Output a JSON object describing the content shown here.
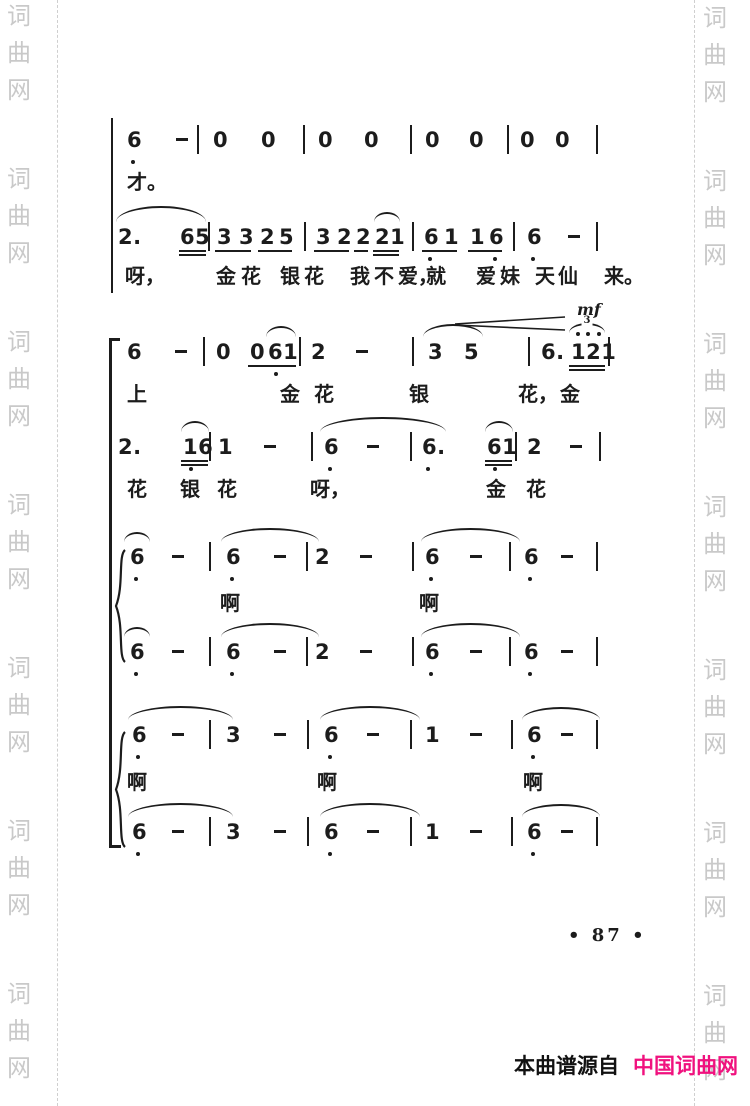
{
  "colors": {
    "ink": "#1c1c1c",
    "watermark": "#c9c9c9",
    "pink": "#f0117e",
    "edge_dash": "#cfcfcf"
  },
  "watermark": {
    "text": "词曲网",
    "chars": [
      "词",
      "曲",
      "网"
    ],
    "repeat_groups": 7,
    "group_pitch": 163,
    "left_start_y": 4,
    "right_start_y": 6
  },
  "footer": {
    "page_number": "• 87 •",
    "source_prefix": "本曲谱源自",
    "source_site": "中国词曲网"
  },
  "score": {
    "notation_system": "jianpu",
    "dynamic_marking": "mf",
    "elements": [
      {
        "kind": "vline",
        "name": "system-barline-1",
        "x": 111,
        "y1": 118,
        "y2": 293,
        "w": 2
      },
      {
        "kind": "vline",
        "name": "system-barline-2",
        "x": 109,
        "y1": 338,
        "y2": 848,
        "w": 3,
        "hooks": true
      },
      {
        "kind": "brace",
        "name": "voice-brace-1",
        "x": 113,
        "y1": 549,
        "y2": 663
      },
      {
        "kind": "brace",
        "name": "voice-brace-2",
        "x": 113,
        "y1": 731,
        "y2": 848
      },
      {
        "kind": "notes",
        "y": 128,
        "tokens": [
          {
            "t": "6",
            "x": 127
          },
          {
            "t": "-",
            "x": 176
          },
          {
            "t": "|",
            "x": 197
          },
          {
            "t": "0",
            "x": 213
          },
          {
            "t": "0",
            "x": 261
          },
          {
            "t": "|",
            "x": 303
          },
          {
            "t": "0",
            "x": 318
          },
          {
            "t": "0",
            "x": 364
          },
          {
            "t": "|",
            "x": 410
          },
          {
            "t": "0",
            "x": 425
          },
          {
            "t": "0",
            "x": 469
          },
          {
            "t": "|",
            "x": 507
          },
          {
            "t": "0",
            "x": 520
          },
          {
            "t": "0",
            "x": 555
          },
          {
            "t": "|",
            "x": 596
          }
        ],
        "dots": [
          {
            "x": 131,
            "pos": "b"
          }
        ]
      },
      {
        "kind": "lyrics",
        "y": 170,
        "items": [
          {
            "t": "才。",
            "x": 127
          }
        ]
      },
      {
        "kind": "notes",
        "y": 225,
        "tokens": [
          {
            "t": "2.",
            "x": 118
          },
          {
            "t": "65",
            "x": 180
          },
          {
            "t": "|",
            "x": 208
          },
          {
            "t": "3",
            "x": 217
          },
          {
            "t": "3",
            "x": 239
          },
          {
            "t": "2",
            "x": 260
          },
          {
            "t": "5",
            "x": 279
          },
          {
            "t": "|",
            "x": 304
          },
          {
            "t": "3",
            "x": 316
          },
          {
            "t": "2",
            "x": 337
          },
          {
            "t": "2",
            "x": 356
          },
          {
            "t": "21",
            "x": 375
          },
          {
            "t": "|",
            "x": 412
          },
          {
            "t": "6",
            "x": 424
          },
          {
            "t": "1",
            "x": 444
          },
          {
            "t": "1",
            "x": 470
          },
          {
            "t": "6",
            "x": 489
          },
          {
            "t": "|",
            "x": 513
          },
          {
            "t": "6",
            "x": 527
          },
          {
            "t": "-",
            "x": 568
          },
          {
            "t": "|",
            "x": 596
          }
        ],
        "slurs": [
          {
            "x1": 116,
            "x2": 206,
            "h": 14
          },
          {
            "x1": 374,
            "x2": 400,
            "h": 8
          }
        ],
        "unders": [
          {
            "x1": 179,
            "x2": 206,
            "n": 2
          },
          {
            "x1": 215,
            "x2": 251,
            "n": 1
          },
          {
            "x1": 258,
            "x2": 292,
            "n": 1
          },
          {
            "x1": 314,
            "x2": 349,
            "n": 1
          },
          {
            "x1": 354,
            "x2": 368,
            "n": 1
          },
          {
            "x1": 373,
            "x2": 399,
            "n": 2
          },
          {
            "x1": 422,
            "x2": 457,
            "n": 1
          },
          {
            "x1": 468,
            "x2": 502,
            "n": 1
          }
        ],
        "dots": [
          {
            "x": 428,
            "pos": "b"
          },
          {
            "x": 493,
            "pos": "b"
          },
          {
            "x": 531,
            "pos": "b"
          }
        ]
      },
      {
        "kind": "lyrics",
        "y": 264,
        "items": [
          {
            "t": "呀，",
            "x": 125
          },
          {
            "t": "金",
            "x": 216
          },
          {
            "t": "花",
            "x": 241
          },
          {
            "t": "银",
            "x": 280
          },
          {
            "t": "花",
            "x": 304
          },
          {
            "t": "我",
            "x": 350
          },
          {
            "t": "不",
            "x": 374
          },
          {
            "t": "爱，",
            "x": 398
          },
          {
            "t": "就",
            "x": 426
          },
          {
            "t": "爱",
            "x": 476
          },
          {
            "t": "妹",
            "x": 500
          },
          {
            "t": "天",
            "x": 535
          },
          {
            "t": "仙",
            "x": 558
          },
          {
            "t": "来。",
            "x": 604
          }
        ]
      },
      {
        "kind": "hairpin",
        "name": "crescendo-hairpin",
        "x1": 455,
        "x2": 565,
        "y": 314
      },
      {
        "kind": "text",
        "name": "dynamic-mf",
        "t": "mf",
        "x": 577,
        "y": 300
      },
      {
        "kind": "notes",
        "y": 340,
        "tokens": [
          {
            "t": "6",
            "x": 127
          },
          {
            "t": "-",
            "x": 175
          },
          {
            "t": "|",
            "x": 203
          },
          {
            "t": "0",
            "x": 216
          },
          {
            "t": "0",
            "x": 250
          },
          {
            "t": "61",
            "x": 268
          },
          {
            "t": "|",
            "x": 299
          },
          {
            "t": "2",
            "x": 311
          },
          {
            "t": "-",
            "x": 356
          },
          {
            "t": "|",
            "x": 412
          },
          {
            "t": "3",
            "x": 428
          },
          {
            "t": "5",
            "x": 464
          },
          {
            "t": "|",
            "x": 528
          },
          {
            "t": "6.",
            "x": 541
          },
          {
            "t": "121",
            "x": 571
          },
          {
            "t": "|",
            "x": 608
          }
        ],
        "slurs": [
          {
            "x1": 266,
            "x2": 296,
            "h": 9
          },
          {
            "x1": 423,
            "x2": 483,
            "h": 11
          },
          {
            "x1": 569,
            "x2": 605,
            "h": 8,
            "label": "3"
          }
        ],
        "unders": [
          {
            "x1": 248,
            "x2": 296,
            "n": 1
          },
          {
            "x1": 569,
            "x2": 605,
            "n": 2
          }
        ],
        "dots": [
          {
            "x": 274,
            "pos": "b"
          },
          {
            "x": 576,
            "pos": "a"
          },
          {
            "x": 586,
            "pos": "a"
          },
          {
            "x": 597,
            "pos": "a"
          }
        ]
      },
      {
        "kind": "lyrics",
        "y": 382,
        "items": [
          {
            "t": "上",
            "x": 127
          },
          {
            "t": "金",
            "x": 280
          },
          {
            "t": "花",
            "x": 314
          },
          {
            "t": "银",
            "x": 409
          },
          {
            "t": "花，",
            "x": 518
          },
          {
            "t": "金",
            "x": 560
          }
        ]
      },
      {
        "kind": "notes",
        "y": 435,
        "tokens": [
          {
            "t": "2.",
            "x": 118
          },
          {
            "t": "16",
            "x": 183
          },
          {
            "t": "|",
            "x": 209
          },
          {
            "t": "1",
            "x": 218
          },
          {
            "t": "-",
            "x": 264
          },
          {
            "t": "|",
            "x": 311
          },
          {
            "t": "6",
            "x": 324
          },
          {
            "t": "-",
            "x": 367
          },
          {
            "t": "|",
            "x": 410
          },
          {
            "t": "6.",
            "x": 422
          },
          {
            "t": "61",
            "x": 487
          },
          {
            "t": "|",
            "x": 515
          },
          {
            "t": "2",
            "x": 527
          },
          {
            "t": "-",
            "x": 570
          },
          {
            "t": "|",
            "x": 599
          }
        ],
        "slurs": [
          {
            "x1": 181,
            "x2": 209,
            "h": 9
          },
          {
            "x1": 320,
            "x2": 446,
            "h": 13
          },
          {
            "x1": 485,
            "x2": 513,
            "h": 9
          }
        ],
        "unders": [
          {
            "x1": 181,
            "x2": 208,
            "n": 2
          },
          {
            "x1": 485,
            "x2": 512,
            "n": 2
          }
        ],
        "dots": [
          {
            "x": 189,
            "pos": "b"
          },
          {
            "x": 328,
            "pos": "b"
          },
          {
            "x": 426,
            "pos": "b"
          },
          {
            "x": 493,
            "pos": "b"
          }
        ]
      },
      {
        "kind": "lyrics",
        "y": 477,
        "items": [
          {
            "t": "花",
            "x": 127
          },
          {
            "t": "银",
            "x": 180
          },
          {
            "t": "花",
            "x": 217
          },
          {
            "t": "呀，",
            "x": 310
          },
          {
            "t": "金",
            "x": 486
          },
          {
            "t": "花",
            "x": 526
          }
        ]
      },
      {
        "kind": "notes",
        "y": 545,
        "tokens": [
          {
            "t": "6",
            "x": 130
          },
          {
            "t": "-",
            "x": 172
          },
          {
            "t": "|",
            "x": 209
          },
          {
            "t": "6",
            "x": 226
          },
          {
            "t": "-",
            "x": 274
          },
          {
            "t": "|",
            "x": 306
          },
          {
            "t": "2",
            "x": 315
          },
          {
            "t": "-",
            "x": 360
          },
          {
            "t": "|",
            "x": 412
          },
          {
            "t": "6",
            "x": 425
          },
          {
            "t": "-",
            "x": 470
          },
          {
            "t": "|",
            "x": 509
          },
          {
            "t": "6",
            "x": 524
          },
          {
            "t": "-",
            "x": 561
          },
          {
            "t": "|",
            "x": 596
          }
        ],
        "slurs": [
          {
            "x1": 124,
            "x2": 150,
            "h": 8
          },
          {
            "x1": 221,
            "x2": 319,
            "h": 12
          },
          {
            "x1": 421,
            "x2": 520,
            "h": 12
          }
        ],
        "dots": [
          {
            "x": 134,
            "pos": "b"
          },
          {
            "x": 230,
            "pos": "b"
          },
          {
            "x": 429,
            "pos": "b"
          },
          {
            "x": 528,
            "pos": "b"
          }
        ]
      },
      {
        "kind": "lyrics",
        "y": 591,
        "items": [
          {
            "t": "啊",
            "x": 220
          },
          {
            "t": "啊",
            "x": 419
          }
        ]
      },
      {
        "kind": "notes",
        "y": 640,
        "tokens": [
          {
            "t": "6",
            "x": 130
          },
          {
            "t": "-",
            "x": 172
          },
          {
            "t": "|",
            "x": 209
          },
          {
            "t": "6",
            "x": 226
          },
          {
            "t": "-",
            "x": 274
          },
          {
            "t": "|",
            "x": 306
          },
          {
            "t": "2",
            "x": 315
          },
          {
            "t": "-",
            "x": 360
          },
          {
            "t": "|",
            "x": 412
          },
          {
            "t": "6",
            "x": 425
          },
          {
            "t": "-",
            "x": 470
          },
          {
            "t": "|",
            "x": 509
          },
          {
            "t": "6",
            "x": 524
          },
          {
            "t": "-",
            "x": 561
          },
          {
            "t": "|",
            "x": 596
          }
        ],
        "slurs": [
          {
            "x1": 124,
            "x2": 150,
            "h": 8
          },
          {
            "x1": 221,
            "x2": 319,
            "h": 12
          },
          {
            "x1": 421,
            "x2": 520,
            "h": 12
          }
        ],
        "dots": [
          {
            "x": 134,
            "pos": "b"
          },
          {
            "x": 230,
            "pos": "b"
          },
          {
            "x": 429,
            "pos": "b"
          },
          {
            "x": 528,
            "pos": "b"
          }
        ]
      },
      {
        "kind": "notes",
        "y": 723,
        "tokens": [
          {
            "t": "6",
            "x": 132
          },
          {
            "t": "-",
            "x": 172
          },
          {
            "t": "|",
            "x": 209
          },
          {
            "t": "3",
            "x": 226
          },
          {
            "t": "-",
            "x": 274
          },
          {
            "t": "|",
            "x": 307
          },
          {
            "t": "6",
            "x": 324
          },
          {
            "t": "-",
            "x": 367
          },
          {
            "t": "|",
            "x": 410
          },
          {
            "t": "1",
            "x": 425
          },
          {
            "t": "-",
            "x": 470
          },
          {
            "t": "|",
            "x": 511
          },
          {
            "t": "6",
            "x": 527
          },
          {
            "t": "-",
            "x": 561
          },
          {
            "t": "|",
            "x": 596
          }
        ],
        "slurs": [
          {
            "x1": 128,
            "x2": 233,
            "h": 12
          },
          {
            "x1": 320,
            "x2": 420,
            "h": 12
          },
          {
            "x1": 522,
            "x2": 600,
            "h": 11
          }
        ],
        "dots": [
          {
            "x": 136,
            "pos": "b"
          },
          {
            "x": 328,
            "pos": "b"
          },
          {
            "x": 531,
            "pos": "b"
          }
        ]
      },
      {
        "kind": "lyrics",
        "y": 770,
        "items": [
          {
            "t": "啊",
            "x": 127
          },
          {
            "t": "啊",
            "x": 317
          },
          {
            "t": "啊",
            "x": 523
          }
        ]
      },
      {
        "kind": "notes",
        "y": 820,
        "tokens": [
          {
            "t": "6",
            "x": 132
          },
          {
            "t": "-",
            "x": 172
          },
          {
            "t": "|",
            "x": 209
          },
          {
            "t": "3",
            "x": 226
          },
          {
            "t": "-",
            "x": 274
          },
          {
            "t": "|",
            "x": 307
          },
          {
            "t": "6",
            "x": 324
          },
          {
            "t": "-",
            "x": 367
          },
          {
            "t": "|",
            "x": 410
          },
          {
            "t": "1",
            "x": 425
          },
          {
            "t": "-",
            "x": 470
          },
          {
            "t": "|",
            "x": 511
          },
          {
            "t": "6",
            "x": 527
          },
          {
            "t": "-",
            "x": 561
          },
          {
            "t": "|",
            "x": 596
          }
        ],
        "slurs": [
          {
            "x1": 128,
            "x2": 233,
            "h": 12
          },
          {
            "x1": 320,
            "x2": 420,
            "h": 12
          },
          {
            "x1": 522,
            "x2": 600,
            "h": 11
          }
        ],
        "dots": [
          {
            "x": 136,
            "pos": "b"
          },
          {
            "x": 328,
            "pos": "b"
          },
          {
            "x": 531,
            "pos": "b"
          }
        ]
      }
    ]
  }
}
